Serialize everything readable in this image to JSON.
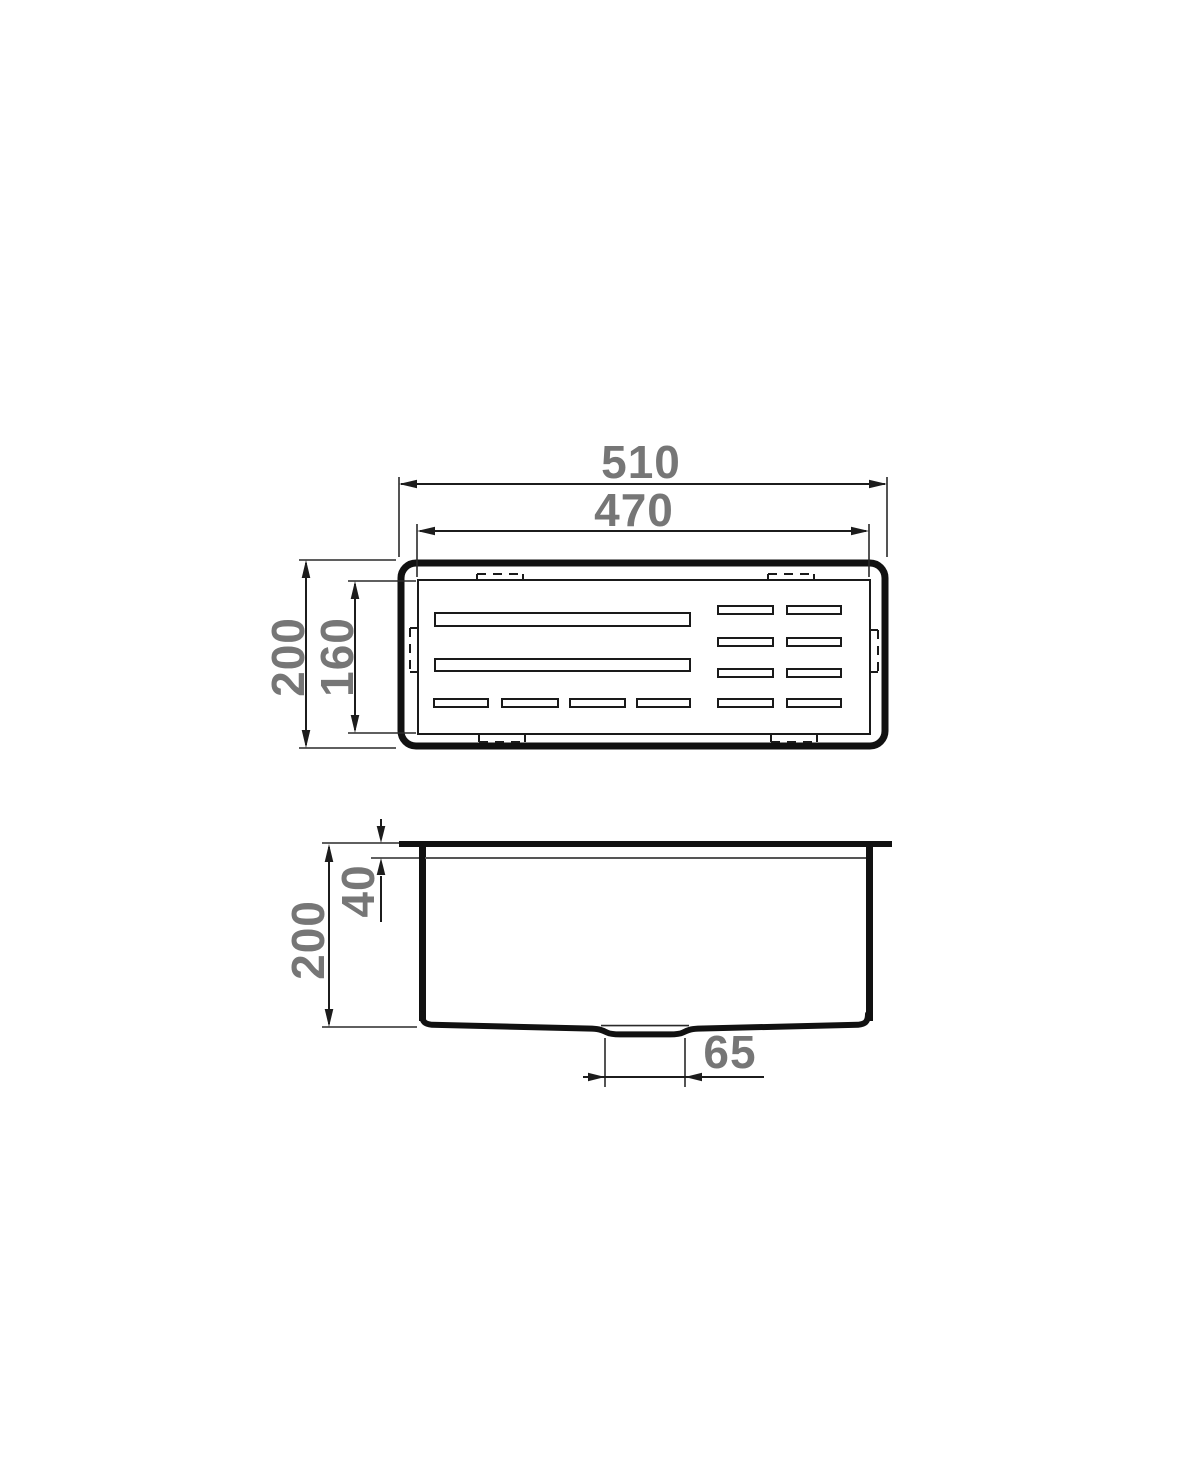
{
  "colors": {
    "line": "#111111",
    "dimension_text": "#767676",
    "background": "#ffffff"
  },
  "top_view": {
    "width_outer": "510",
    "width_inner": "470",
    "depth_outer": "200",
    "depth_inner": "160"
  },
  "side_view": {
    "height_total": "200",
    "depth_top": "40",
    "drain_width": "65"
  }
}
